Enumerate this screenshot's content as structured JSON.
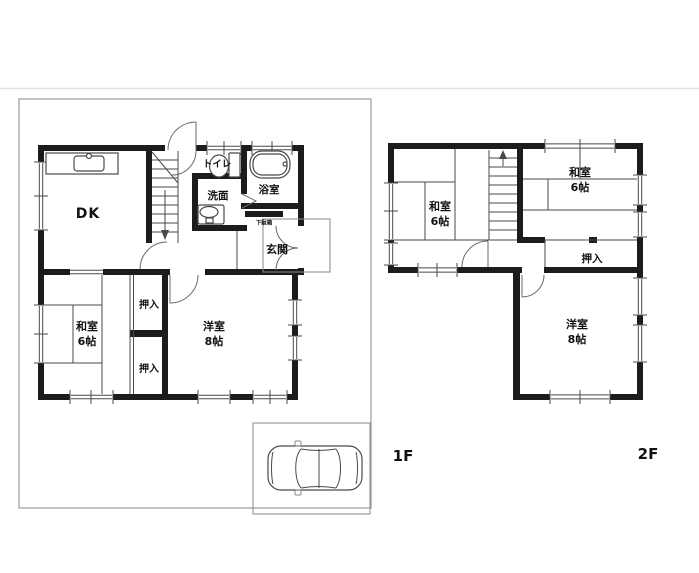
{
  "colors": {
    "wall": "#1c1c1c",
    "line": "#4a4a4a",
    "boundary": "#9a9a9a",
    "text": "#111111",
    "background": "#ffffff"
  },
  "floor_1f": {
    "floor_label": "1F",
    "rooms": {
      "dk": {
        "label": "DK"
      },
      "toilet": {
        "label": "トイレ"
      },
      "bath": {
        "label": "浴室"
      },
      "washroom": {
        "label": "洗面"
      },
      "shoe_cabinet": {
        "label": "下駄箱"
      },
      "entrance": {
        "label": "玄関"
      },
      "closet_upper": {
        "label": "押入"
      },
      "closet_lower": {
        "label": "押入"
      },
      "japanese_room": {
        "label": "和室",
        "size": "6帖"
      },
      "western_room": {
        "label": "洋室",
        "size": "8帖"
      }
    }
  },
  "floor_2f": {
    "floor_label": "2F",
    "rooms": {
      "japanese_room_left": {
        "label": "和室",
        "size": "6帖"
      },
      "japanese_room_right": {
        "label": "和室",
        "size": "6帖"
      },
      "closet": {
        "label": "押入"
      },
      "western_room": {
        "label": "洋室",
        "size": "8帖"
      }
    }
  },
  "icons": {
    "car": "car-icon",
    "kitchen_sink": "kitchen-sink-icon",
    "toilet": "toilet-icon",
    "bathtub": "bathtub-icon",
    "washbasin": "washbasin-icon",
    "stairs_1f_direction": "down-arrow",
    "stairs_2f_direction": "up-arrow"
  }
}
